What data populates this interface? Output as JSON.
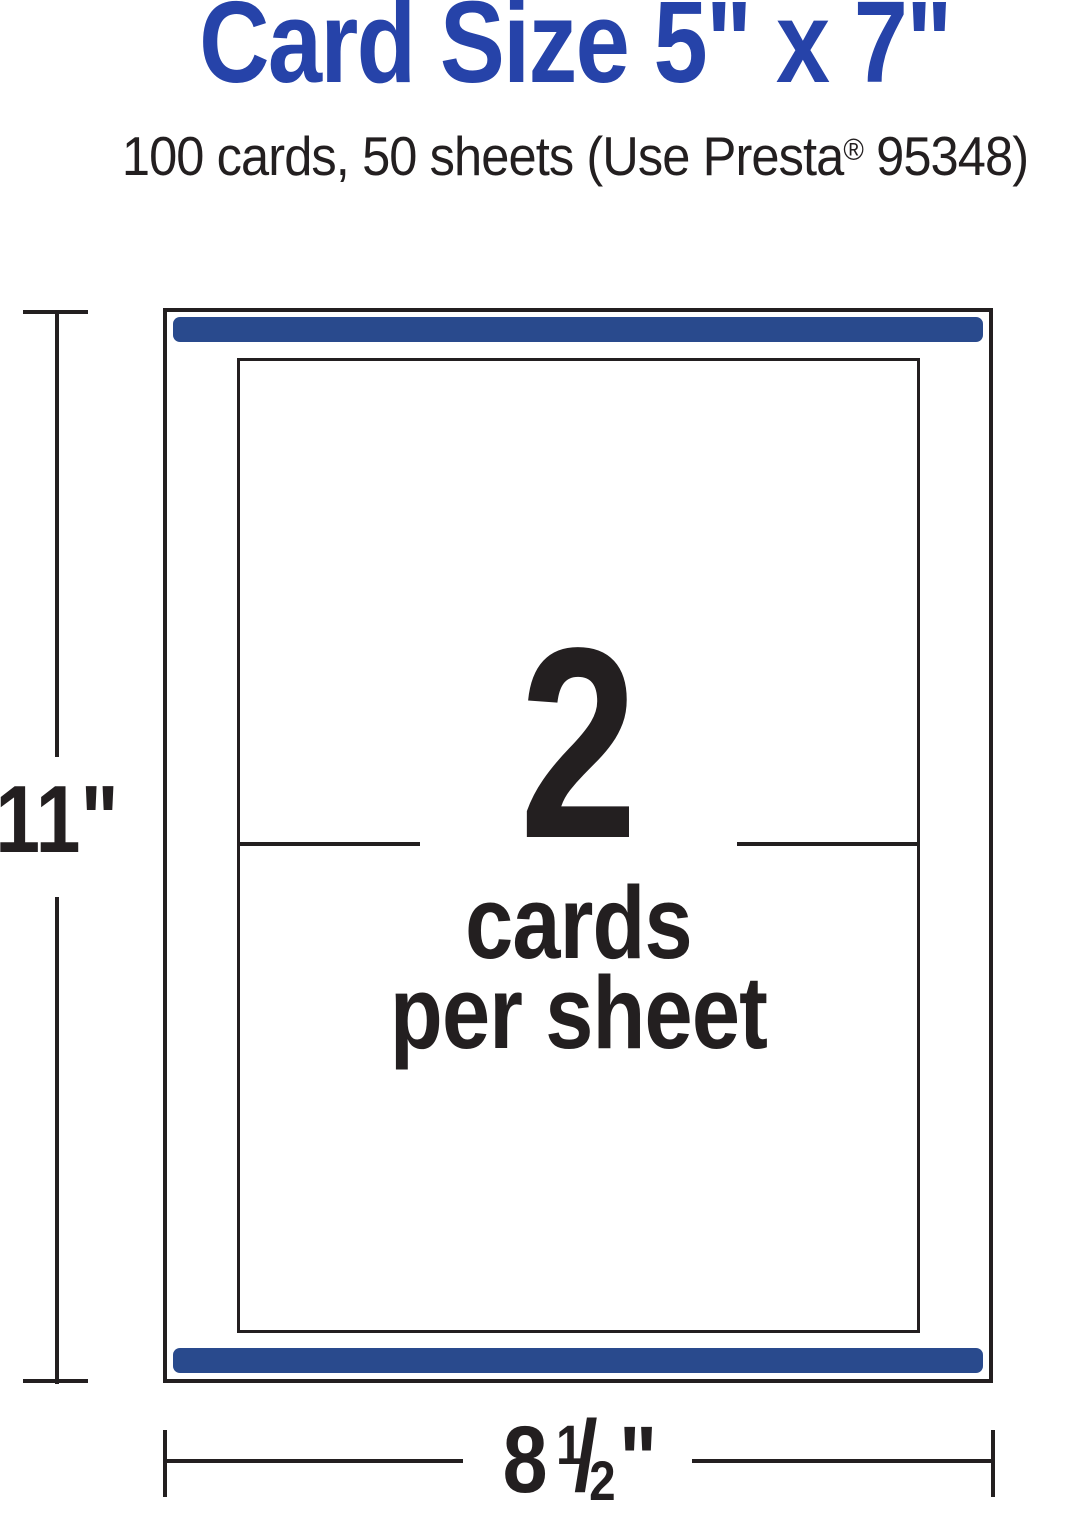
{
  "colors": {
    "title_blue": "#2643a9",
    "bar_blue": "#294a8d",
    "ink_black": "#231f20"
  },
  "title": "Card Size 5\" x 7\"",
  "subtitle": {
    "part1": "100 cards, 50 sheets (Use Presta",
    "registered_mark": "®",
    "part2": " 95348)"
  },
  "sheet_diagram": {
    "cards_per_sheet_count": "2",
    "label_line1": "cards",
    "label_line2": "per sheet",
    "height_dimension_label": "11\"",
    "width_dimension": {
      "whole": "8",
      "fraction_numerator": "1",
      "fraction_slash": "/",
      "fraction_denominator": "2",
      "inch_mark": "\""
    }
  }
}
